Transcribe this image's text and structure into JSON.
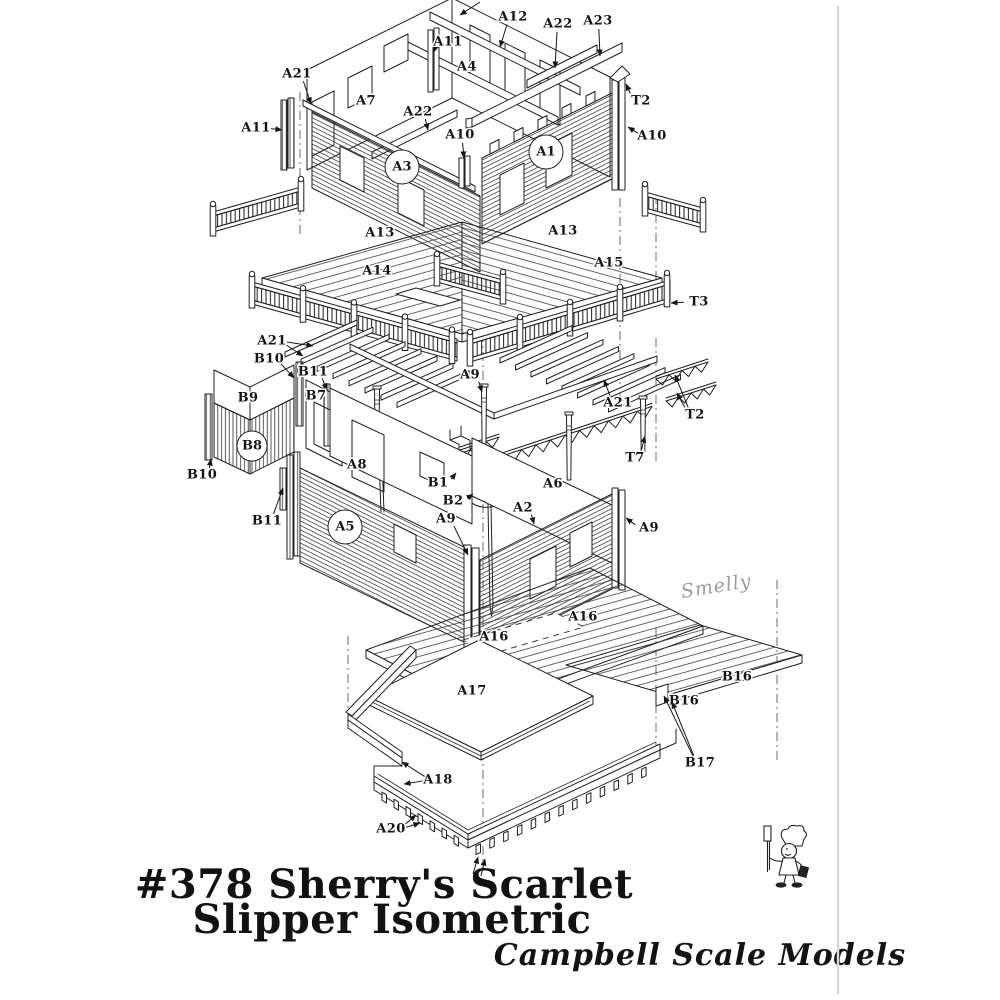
{
  "page": {
    "background": "#ffffff",
    "page_edge_color": "#d8d8d8",
    "ink": "#1f1f1f"
  },
  "title": {
    "line1": "#378 Sherry's Scarlet",
    "line2": "Slipper Isometric"
  },
  "brand": {
    "name": "Campbell Scale Models",
    "mascot": "chef-mascot"
  },
  "signature": "Smelly",
  "diagram": {
    "type": "exploded-isometric-assembly",
    "labels": [
      {
        "text": "A12",
        "x": 513,
        "y": 17,
        "leads": [
          [
            500,
            47
          ]
        ]
      },
      {
        "text": "A22",
        "x": 558,
        "y": 24,
        "leads": [
          [
            555,
            68
          ]
        ]
      },
      {
        "text": "A23",
        "x": 598,
        "y": 21,
        "leads": [
          [
            600,
            56
          ]
        ]
      },
      {
        "text": "A11",
        "x": 448,
        "y": 42,
        "leads": [
          [
            434,
            52
          ]
        ]
      },
      {
        "text": "A21",
        "x": 297,
        "y": 74,
        "leads": [
          [
            311,
            104
          ]
        ]
      },
      {
        "text": "A11",
        "x": 256,
        "y": 128,
        "leads": [
          [
            282,
            130
          ]
        ]
      },
      {
        "text": "A7",
        "x": 366,
        "y": 101
      },
      {
        "text": "A4",
        "x": 467,
        "y": 67
      },
      {
        "text": "A22",
        "x": 418,
        "y": 112,
        "leads": [
          [
            428,
            130
          ]
        ]
      },
      {
        "text": "A10",
        "x": 460,
        "y": 135,
        "leads": [
          [
            464,
            158
          ]
        ]
      },
      {
        "text": "T2",
        "x": 641,
        "y": 101,
        "leads": [
          [
            626,
            84
          ]
        ]
      },
      {
        "text": "A10",
        "x": 652,
        "y": 136,
        "leads": [
          [
            628,
            127
          ]
        ]
      },
      {
        "text": "A13",
        "x": 380,
        "y": 233
      },
      {
        "text": "A13",
        "x": 563,
        "y": 231
      },
      {
        "text": "A14",
        "x": 377,
        "y": 271
      },
      {
        "text": "A15",
        "x": 609,
        "y": 263
      },
      {
        "text": "T3",
        "x": 699,
        "y": 302,
        "leads": [
          [
            671,
            303
          ]
        ]
      },
      {
        "text": "A21",
        "x": 272,
        "y": 341,
        "leads": [
          [
            313,
            346
          ],
          [
            303,
            356
          ]
        ]
      },
      {
        "text": "B10",
        "x": 269,
        "y": 359,
        "leads": [
          [
            294,
            378
          ]
        ]
      },
      {
        "text": "B11",
        "x": 313,
        "y": 372,
        "leads": [
          [
            327,
            390
          ]
        ]
      },
      {
        "text": "B9",
        "x": 248,
        "y": 398
      },
      {
        "text": "B7",
        "x": 316,
        "y": 396
      },
      {
        "text": "B10",
        "x": 202,
        "y": 475,
        "leads": [
          [
            211,
            459
          ]
        ]
      },
      {
        "text": "B11",
        "x": 267,
        "y": 521,
        "leads": [
          [
            283,
            488
          ]
        ]
      },
      {
        "text": "A8",
        "x": 357,
        "y": 465
      },
      {
        "text": "A9",
        "x": 470,
        "y": 375,
        "leads": [
          [
            482,
            392
          ]
        ]
      },
      {
        "text": "B1",
        "x": 438,
        "y": 483,
        "leads": [
          [
            456,
            473
          ]
        ]
      },
      {
        "text": "B2",
        "x": 453,
        "y": 501,
        "leads": [
          [
            473,
            494
          ]
        ]
      },
      {
        "text": "A9",
        "x": 446,
        "y": 519,
        "leads": [
          [
            468,
            555
          ]
        ]
      },
      {
        "text": "A2",
        "x": 523,
        "y": 508,
        "leads": [
          [
            534,
            524
          ]
        ]
      },
      {
        "text": "A21",
        "x": 618,
        "y": 403,
        "leads": [
          [
            604,
            380
          ]
        ]
      },
      {
        "text": "T2",
        "x": 695,
        "y": 415,
        "leads": [
          [
            675,
            375
          ],
          [
            677,
            393
          ]
        ]
      },
      {
        "text": "T7",
        "x": 635,
        "y": 458,
        "leads": [
          [
            645,
            436
          ]
        ]
      },
      {
        "text": "A6",
        "x": 553,
        "y": 484
      },
      {
        "text": "A9",
        "x": 649,
        "y": 528,
        "leads": [
          [
            626,
            518
          ]
        ]
      },
      {
        "text": "A16",
        "x": 583,
        "y": 617
      },
      {
        "text": "A16",
        "x": 494,
        "y": 637
      },
      {
        "text": "A17",
        "x": 472,
        "y": 691
      },
      {
        "text": "B16",
        "x": 737,
        "y": 677
      },
      {
        "text": "B16",
        "x": 684,
        "y": 701
      },
      {
        "text": "B17",
        "x": 700,
        "y": 763,
        "leads": [
          [
            664,
            696
          ],
          [
            672,
            702
          ]
        ]
      },
      {
        "text": "A18",
        "x": 438,
        "y": 780,
        "leads": [
          [
            402,
            762
          ],
          [
            404,
            784
          ]
        ]
      },
      {
        "text": "A20",
        "x": 391,
        "y": 829,
        "leads": [
          [
            416,
            815
          ],
          [
            420,
            823
          ]
        ]
      }
    ],
    "circled_labels": [
      {
        "text": "A3",
        "x": 402,
        "y": 167,
        "r": 17
      },
      {
        "text": "A1",
        "x": 546,
        "y": 152,
        "r": 17
      },
      {
        "text": "A5",
        "x": 345,
        "y": 527,
        "r": 17
      },
      {
        "text": "B8",
        "x": 252,
        "y": 446,
        "r": 15
      }
    ]
  }
}
